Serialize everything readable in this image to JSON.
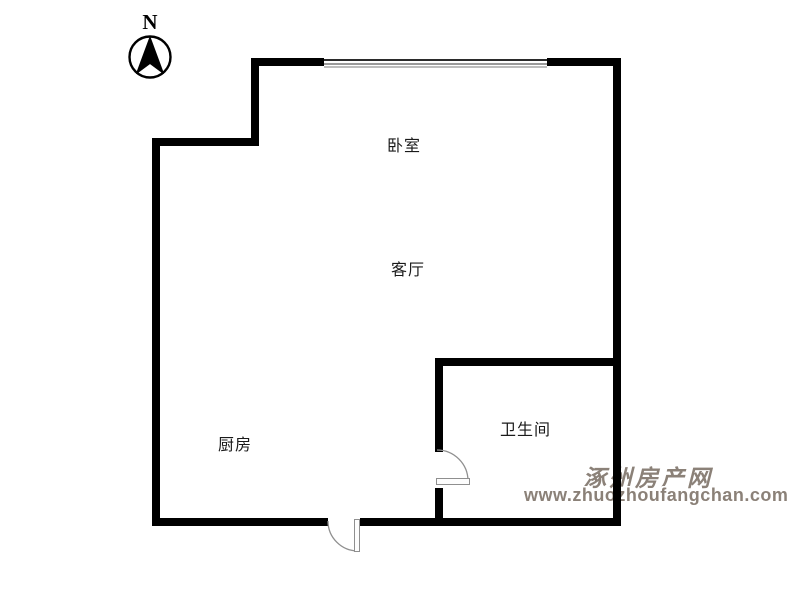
{
  "compass": {
    "label": "N"
  },
  "rooms": {
    "bedroom": "卧室",
    "living_room": "客厅",
    "kitchen": "厨房",
    "bathroom": "卫生间"
  },
  "watermark": {
    "site_name": "涿州房产网",
    "site_url": "www.zhuozhoufangchan.com",
    "color": "#8b8178"
  },
  "colors": {
    "background": "#ffffff",
    "wall": "#000000",
    "label": "#1a1a1a",
    "window_line_dark": "#2b2b2b",
    "window_line_mid": "#9a9a9a",
    "window_line_light": "#bdbdbd",
    "door_arc": "#8f8f8f"
  }
}
